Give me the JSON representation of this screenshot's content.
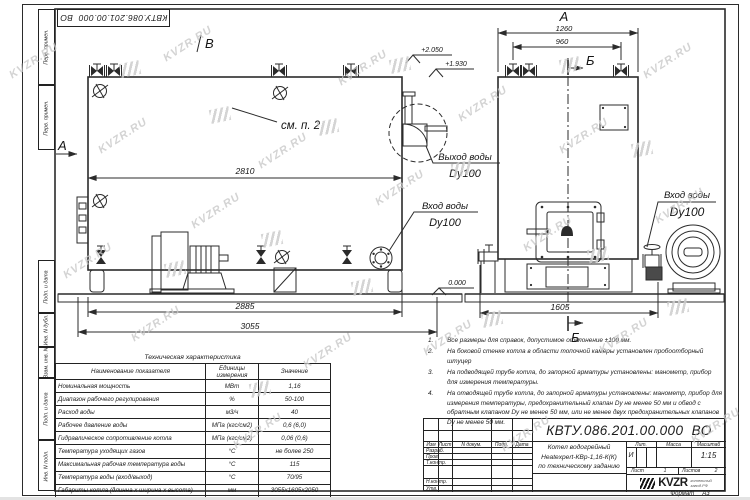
{
  "watermark": {
    "text": "KVZR.RU"
  },
  "stamp_top": {
    "doc_number": "КВТУ.086.201.00.000  ВО"
  },
  "margin": {
    "labels": [
      "Перв. примен.",
      "Перв. примен.",
      "Подп. и дата",
      "Инв. N дубл.",
      "Взам. инв. N",
      "Подп. и дата",
      "Инв. N подл."
    ]
  },
  "drawing": {
    "side_view": {
      "view_label": "В",
      "section_label": "А",
      "detail_note": "см. п. 2",
      "elev_top": "+2.050",
      "elev_mid": "+1.930",
      "elev_zero": "0.000",
      "dim_body": "2810",
      "dim_frame": "2885",
      "dim_overall": "3055",
      "outlet_label": "Выход воды",
      "inlet_label": "Вход воды",
      "dn_label": "Dy100"
    },
    "front_view": {
      "view_label": "А",
      "section_label": "Б",
      "dim_width": "1260",
      "dim_valves": "960",
      "dim_base": "1605",
      "inlet_label": "Вход воды",
      "dn_label": "Dy100"
    }
  },
  "notes": {
    "items": [
      {
        "num": "1.",
        "text": "Все размеры для справок, допустимое отклонение ±100 мм."
      },
      {
        "num": "2.",
        "text": "На боковой стенке котла в области топочной камеры установлен пробоотборный штуцер"
      },
      {
        "num": "3.",
        "text": "На подводящей трубе котла, до запорной арматуры установлены: манометр, прибор для измерения температуры."
      },
      {
        "num": "4.",
        "text": "На отводящей трубе котла, до запорной арматуры установлены: манометр, прибор для измерения температуры, предохранительный клапан Dу не менее 50 мм и обвод с обратным клапаном Dу не менее 50 мм, или не менее двух предохранительных клапанов Dу не менее 50 мм."
      }
    ]
  },
  "spec_table": {
    "title": "Техническая характеристика",
    "headers": [
      "Наименование показателя",
      "Единицы измерения",
      "Значение"
    ],
    "rows": [
      [
        "Номинальная мощность",
        "МВт",
        "1,16"
      ],
      [
        "Диапазон рабочего регулирования",
        "%",
        "50-100"
      ],
      [
        "Расход воды",
        "м3/ч",
        "40"
      ],
      [
        "Рабочее давление воды",
        "МПа (кгс/см2)",
        "0,6 (6,0)"
      ],
      [
        "Гидравлическое сопротивление котла",
        "МПа (кгс/см2)",
        "0,06 (0,6)"
      ],
      [
        "Температура уходящих газов",
        "°С",
        "не более 250"
      ],
      [
        "Максимальная рабочая температура воды",
        "°С",
        "115"
      ],
      [
        "Температура воды (вход/выход)",
        "°С",
        "70/95"
      ],
      [
        "Габариты котла (длинна х ширина х высота)",
        "мм",
        "3055х1605х2050"
      ]
    ]
  },
  "title_block": {
    "doc_number": "КВТУ.086.201.00.000  ВО",
    "columns": [
      "Изм",
      "Лист",
      "N докум.",
      "Подп.",
      "Дата"
    ],
    "rows": [
      "Разраб.",
      "Пров.",
      "Т.контр.",
      "Н.контр.",
      "Утв."
    ],
    "product_lines": [
      "Котел водогрейный",
      "Heatexpert-КВр-1,16-К(К)",
      "по техническому заданию"
    ],
    "lit_label": "Лит.",
    "lit_value": "И",
    "mass_label": "Масса",
    "scale_label": "Масштаб",
    "scale_value": "1:15",
    "sheet_label": "Лист",
    "sheet_value": "1",
    "sheets_label": "Листов",
    "sheets_value": "2",
    "logo_text": "KVZR",
    "logo_caption": [
      "котельный",
      "завод.РФ"
    ]
  },
  "footer": {
    "format_label": "Формат",
    "format_value": "А3"
  }
}
